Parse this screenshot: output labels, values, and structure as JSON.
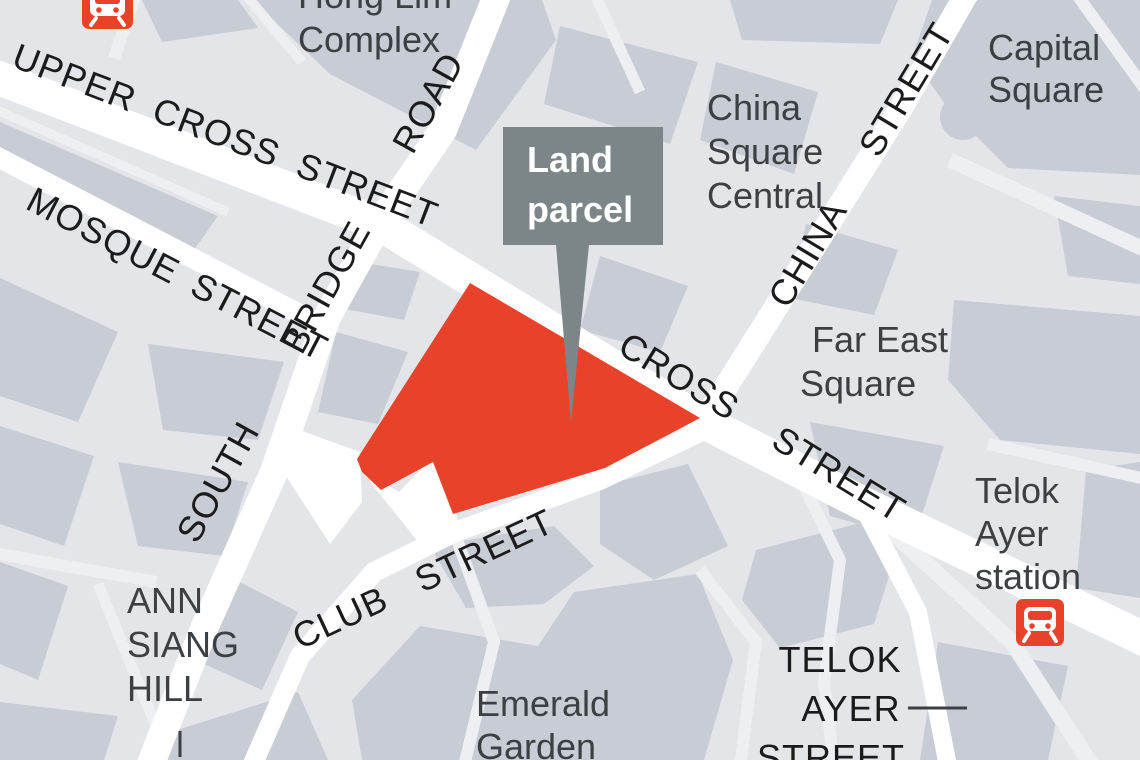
{
  "colors": {
    "background": "#e3e5e9",
    "block": "#c7ccd5",
    "street": "#ffffff",
    "lane": "#edeff3",
    "parcel_red": "#e8432a",
    "callout_gray": "#7c8689",
    "callout_text": "#ffffff",
    "street_label": "#1b1b1b",
    "place_label": "#3c4043"
  },
  "parcel": {
    "points": "470,283 700,418 605,468 453,514 433,462 381,490 362,472 357,459"
  },
  "callout": {
    "line1": "Land",
    "line2": "parcel",
    "pointer_points": "556,245 589,245 571,422"
  },
  "streets": {
    "upper_cross": "UPPER CROSS STREET",
    "mosque": "MOSQUE STREET",
    "south_bridge": "SOUTH BRIDGE ROAD",
    "china": "CHINA STREET",
    "cross": "CROSS STREET",
    "club": "CLUB STREET",
    "telok_ayer_l1": "TELOK",
    "telok_ayer_l2": "AYER",
    "telok_ayer_l3": "STREET"
  },
  "places": {
    "hong_lim_l1": "Hong Lim",
    "hong_lim_l2": "Complex",
    "capital_l1": "Capital",
    "capital_l2": "Square",
    "china_square_l1": "China",
    "china_square_l2": "Square",
    "china_square_l3": "Central",
    "far_east_l1": "Far East",
    "far_east_l2": "Square",
    "station_l1": "Telok",
    "station_l2": "Ayer",
    "station_l3": "station",
    "ann_siang_l1": "ANN",
    "ann_siang_l2": "SIANG",
    "ann_siang_l3": "HILL",
    "emerald_l1": "Emerald",
    "emerald_l2": "Garden"
  },
  "icons": {
    "station": "train-station-icon"
  }
}
